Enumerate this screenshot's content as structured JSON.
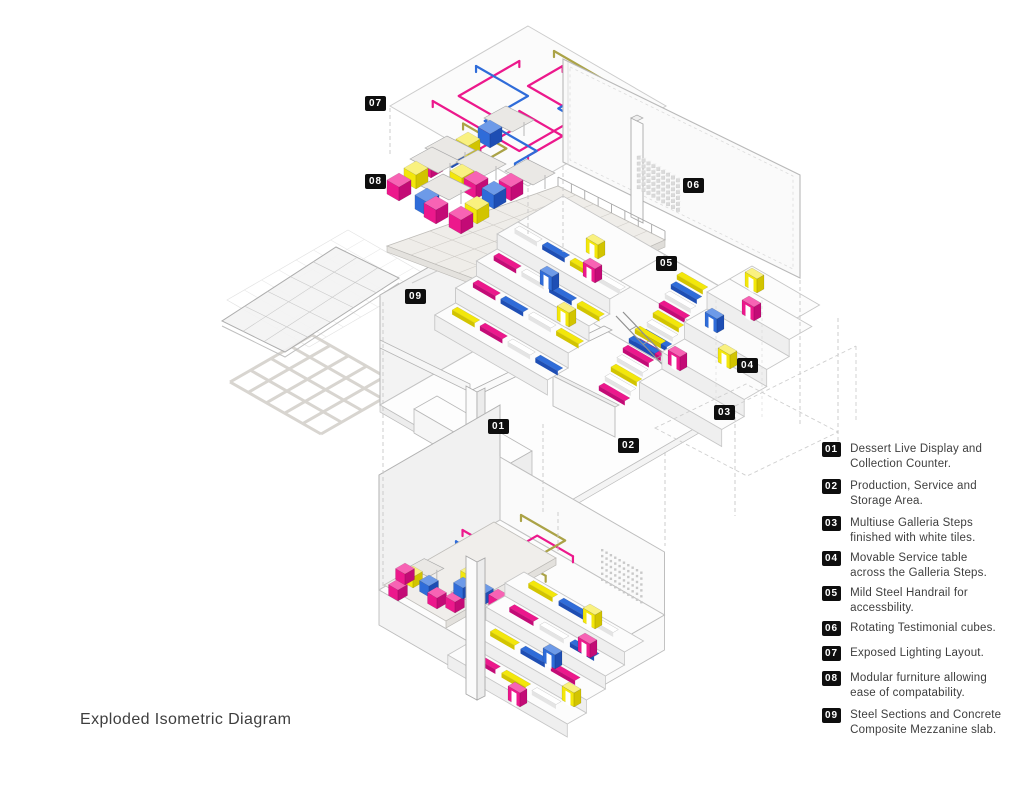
{
  "title": "Exploded Isometric Diagram",
  "colors": {
    "magenta": "#EC188C",
    "blue": "#2F6CD9",
    "yellow": "#F3E70B",
    "olive": "#ABA347",
    "tag_bg": "#0E0E0E",
    "tag_text": "#FFFFFF",
    "text": "#3E3E3E"
  },
  "diagram_markers": [
    "01",
    "02",
    "03",
    "04",
    "05",
    "06",
    "07",
    "08",
    "09"
  ],
  "legend": {
    "items": [
      {
        "num": "01",
        "lines": [
          "Dessert Live Display and",
          "Collection Counter."
        ]
      },
      {
        "num": "02",
        "lines": [
          "Production, Service and",
          "Storage Area."
        ]
      },
      {
        "num": "03",
        "lines": [
          "Multiuse Galleria Steps",
          "finished with white tiles."
        ]
      },
      {
        "num": "04",
        "lines": [
          "Movable Service table",
          "across the Galleria Steps."
        ]
      },
      {
        "num": "05",
        "lines": [
          "Mild Steel Handrail for",
          "accessbility."
        ]
      },
      {
        "num": "06",
        "lines": [
          "Rotating Testimonial cubes."
        ]
      },
      {
        "num": "07",
        "lines": [
          "Exposed Lighting Layout."
        ]
      },
      {
        "num": "08",
        "lines": [
          "Modular furniture allowing",
          "ease of compatability."
        ]
      },
      {
        "num": "09",
        "lines": [
          "Steel Sections and Concrete",
          "Composite Mezzanine slab."
        ]
      }
    ]
  }
}
